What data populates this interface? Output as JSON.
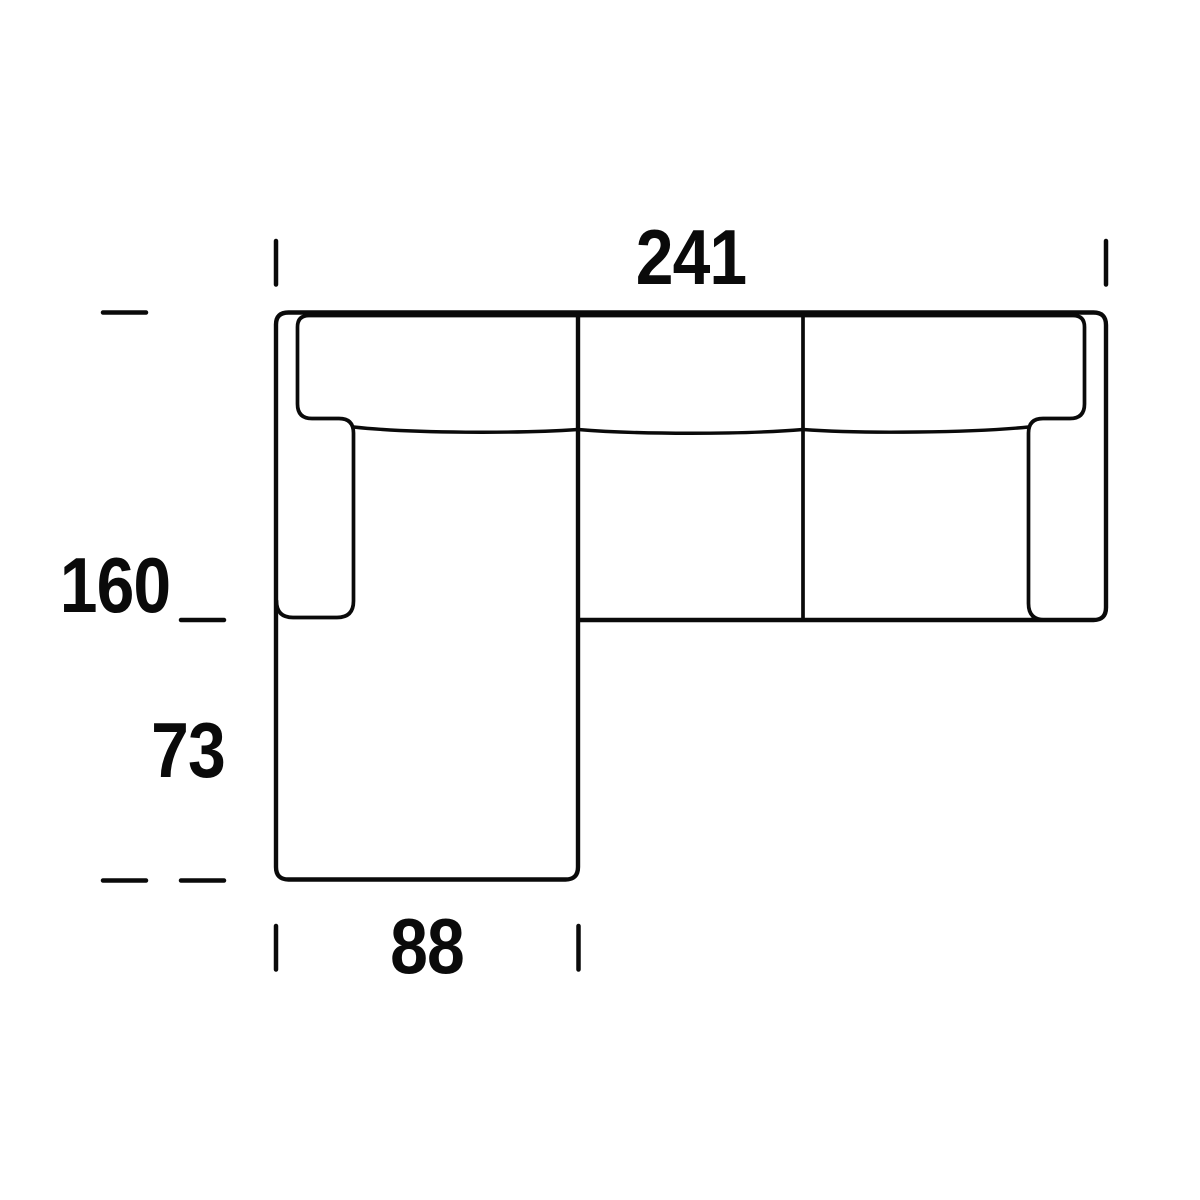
{
  "figure": {
    "type": "sofa-top-view-dimension-diagram",
    "description": "Technical top-view line drawing of a three-seat sectional sofa with left chaise longue and dimension annotations",
    "background_color": "#ffffff",
    "line_color": "#0a0a0a",
    "dimensions": {
      "top_width": "241",
      "left_total_depth": "160",
      "left_open_section": "73",
      "bottom_chaise_width": "88"
    }
  },
  "geometry": {
    "outer_path": "M 578 314 L 578 867 Q 578 879.5 565.5 879.5 L 288.5 879.5 Q 276 879.5 276 867 L 276 324.5 Q 276 312.5 288.5 312.5 L 1093.5 312.5 Q 1106 312.5 1106 325 L 1106 607.5 Q 1106 620 1093.5 620 L 578 620",
    "inner_path": "M 276.5 601 Q 276.5 617.5 293 617.5 L 337 617.5 Q 353.5 617.5 353.5 601 L 353.5 433 Q 353.5 418.5 339 418.5 L 312 418.5 Q 297.5 418.5 297.5 404 L 297.5 327 Q 297.5 315.5 309 315.5 L 1073 315.5 Q 1084.5 315.5 1084.5 327 L 1084.5 404 Q 1084.5 418.5 1070 418.5 L 1043 418.5 Q 1028.5 418.5 1028.5 433 L 1028.5 603.5 Q 1028.5 620 1045 620 L 1056 620",
    "divider_path": "M 803 314.5 L 803 620",
    "cushion_curves_path": "M 353.5 427 C 413 433.5 518 433.5 578 429.5 C 638 434.5 743 434.5 803 429.5 C 863 434 973 432.5 1028.5 427",
    "ticks_path": "M 276 241 L 276 284.5 M 1106 241 L 1106 284.5 M 276 926 L 276 969.5 M 578.5 926 L 578.5 969.5 M 103 312.5 L 146 312.5 M 103 880.5 L 146 880.5 M 181 620 L 224 620 M 181 880.5 L 224 880.5"
  }
}
